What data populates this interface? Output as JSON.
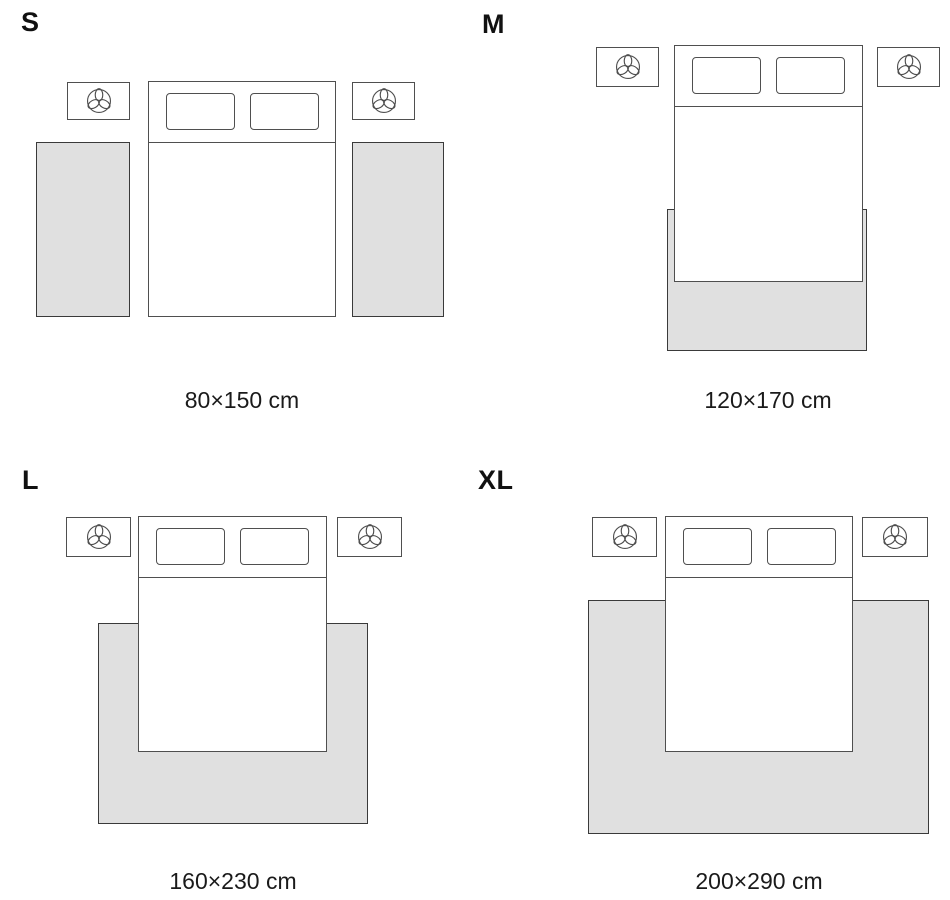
{
  "diagram": {
    "type": "rug-size-guide",
    "colors": {
      "background": "#ffffff",
      "outline": "#4f4f4f",
      "rug_fill": "#e0e0e0",
      "rug_border": "#3a3a3a",
      "text": "#111111"
    },
    "icons": {
      "nightstand_icon": "plant-icon"
    },
    "sizes": [
      {
        "label": "S",
        "dimensions": "80×150 cm"
      },
      {
        "label": "M",
        "dimensions": "120×170 cm"
      },
      {
        "label": "L",
        "dimensions": "160×230 cm"
      },
      {
        "label": "XL",
        "dimensions": "200×290 cm"
      }
    ]
  }
}
